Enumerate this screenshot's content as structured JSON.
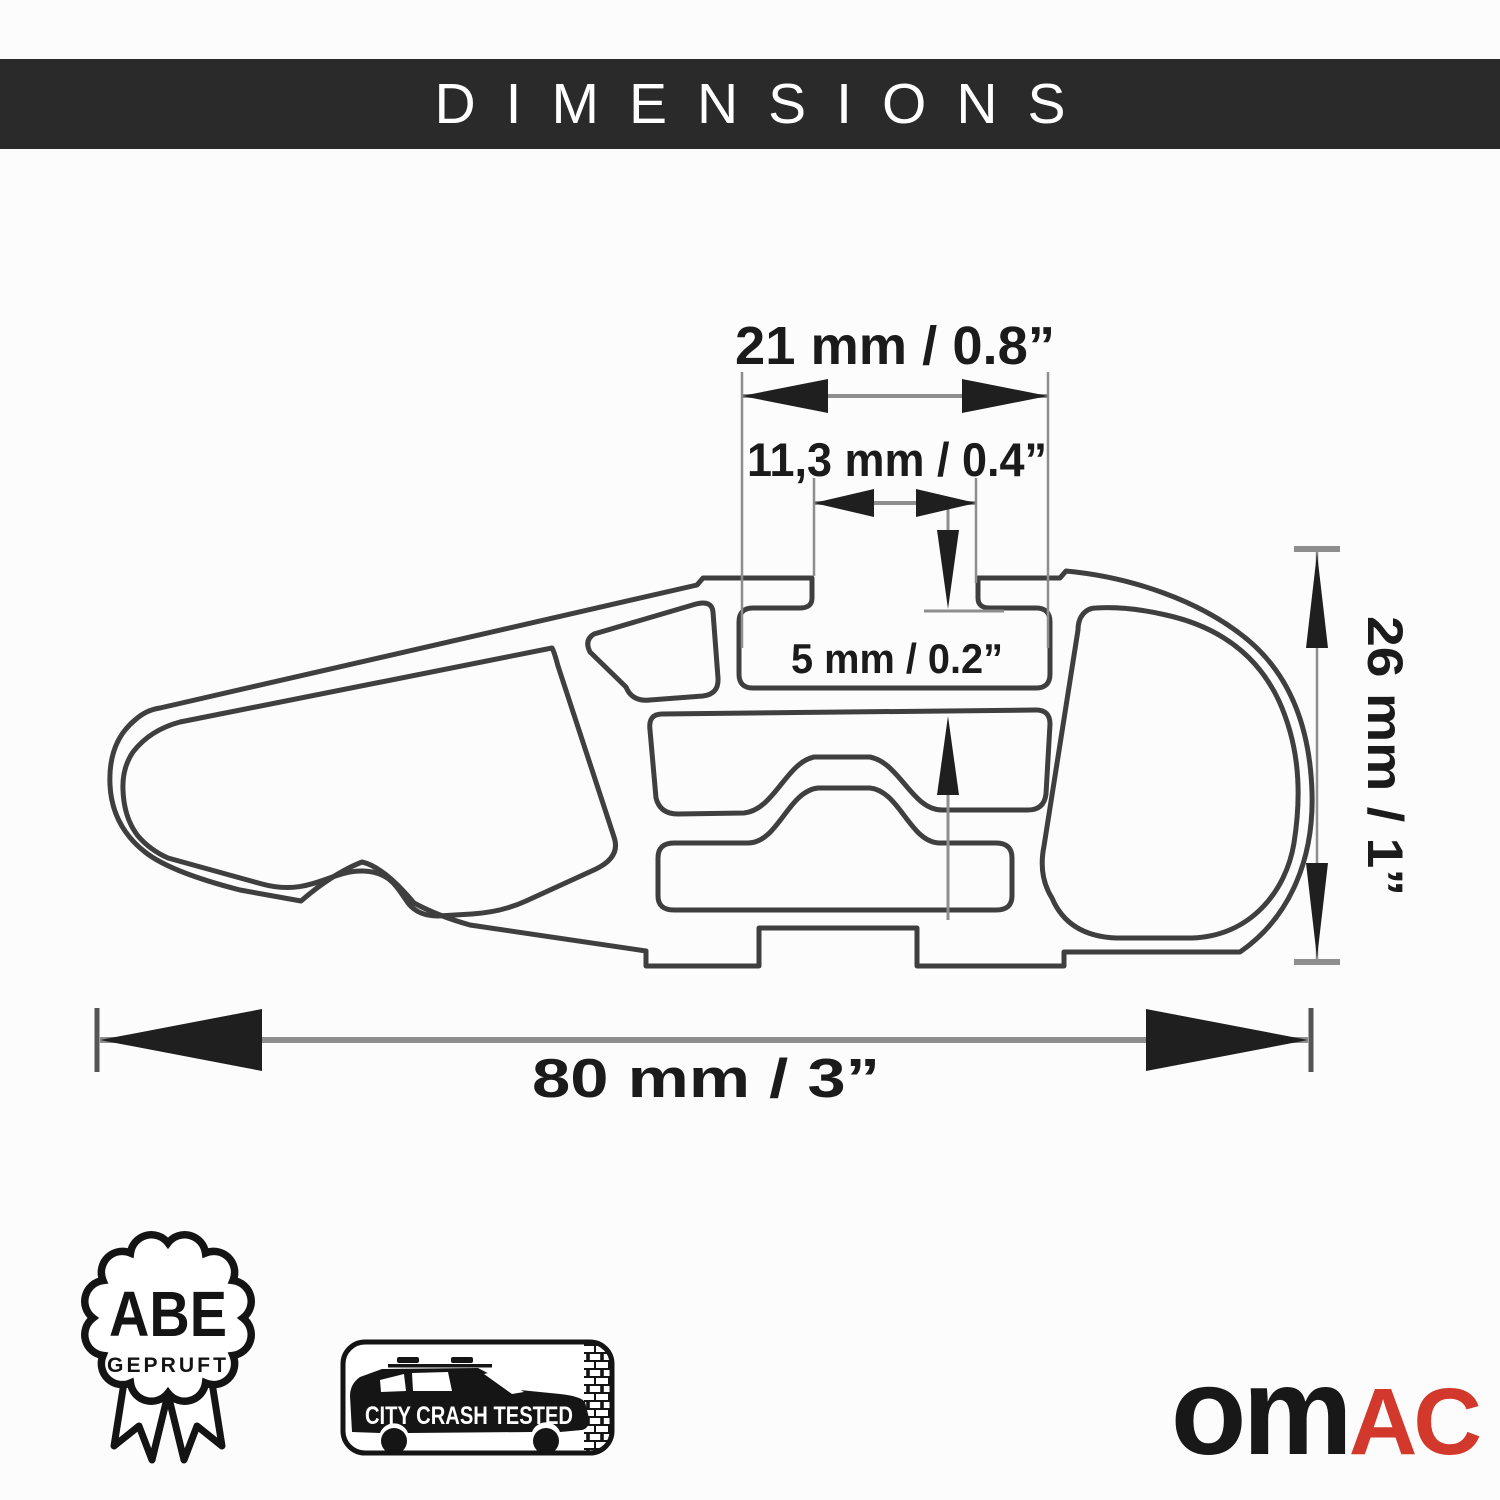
{
  "header": {
    "title": "DIMENSIONS",
    "bg_color": "#2a2a2b",
    "text_color": "#ffffff"
  },
  "drawing": {
    "labels": {
      "channel_width": "21 mm / 0.8”",
      "opening_width": "11,3 mm / 0.4”",
      "slot_depth": "5 mm / 0.2”",
      "bar_height": "26 mm / 1”",
      "bar_width": "80 mm / 3”"
    },
    "colors": {
      "outline": "#3f3f3f",
      "dimension_line": "#8e8e8e",
      "arrow": "#1f1f1f",
      "label_text": "#1b1b1b"
    }
  },
  "badges": {
    "abe": {
      "title": "ABE",
      "subtitle": "GEPRUFT"
    },
    "crash_test": {
      "label": "CITY CRASH TESTED"
    }
  },
  "logo": {
    "part1": "om",
    "part2": "AC",
    "part1_color": "#181818",
    "part2_color": "#d2382c"
  }
}
